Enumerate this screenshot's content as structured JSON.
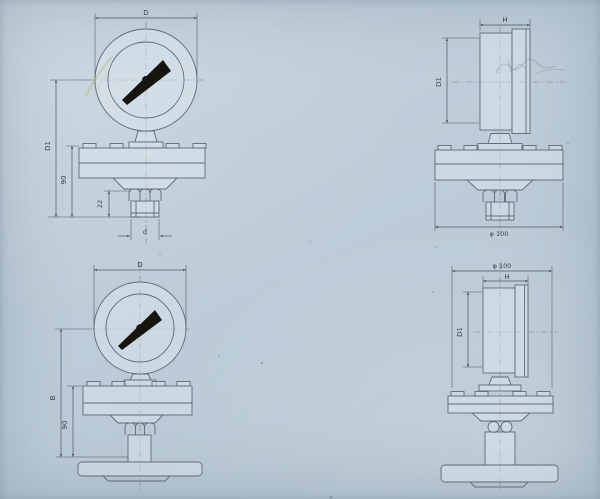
{
  "drawing": {
    "colors": {
      "paper_background": "#bdccd8",
      "object_line": "#5f6a75",
      "dimension_line": "#4d5863",
      "needle": "#15150e",
      "label_text": "#39434d"
    },
    "views": {
      "front_threaded": {
        "labels": {
          "dial_diameter": "D",
          "overall_height": "D1",
          "body_height": "90",
          "nut_length": "22",
          "thread_diameter": "d"
        }
      },
      "side_threaded": {
        "labels": {
          "case_depth": "H",
          "case_height": "D1",
          "flange_diameter": "φ 100"
        }
      },
      "front_flanged": {
        "labels": {
          "dial_diameter": "D",
          "overall_height": "B",
          "body_height": "90"
        }
      },
      "side_flanged": {
        "labels": {
          "flange_diameter": "φ 100",
          "case_depth": "H",
          "case_height": "D1"
        }
      }
    }
  }
}
